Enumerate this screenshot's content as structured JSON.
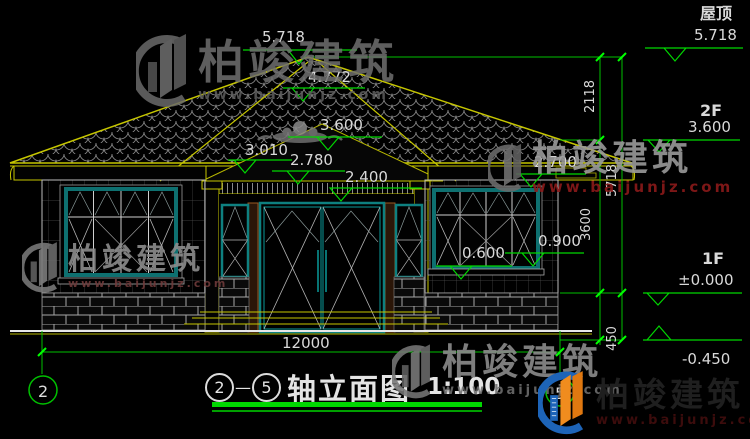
{
  "watermark": {
    "brand": "柏竣建筑",
    "url": "www.baijunjz.com"
  },
  "right_column": {
    "roof_label": "屋顶",
    "roof_level": "5.718",
    "f2_label": "2F",
    "f2_level": "3.600",
    "f1_label": "1F",
    "f1_level": "±0.000",
    "ground_level": "-0.450"
  },
  "levels": {
    "apex": "5.718",
    "ridge2": "4.772",
    "gable": "3.600",
    "eave_left": "3.010",
    "beam": "2.780",
    "door_top": "2.400",
    "eave_right": "2.700",
    "sill_left": "0.600",
    "sill_right": "0.900"
  },
  "dims": {
    "width": "12000",
    "roof_h": "2118",
    "total_h": "5718",
    "floor_h": "3600",
    "plinth_h": "450"
  },
  "axes": {
    "left": "2",
    "right": "5",
    "dash": "—"
  },
  "title": {
    "name": "轴立面图",
    "scale": "1:100"
  }
}
